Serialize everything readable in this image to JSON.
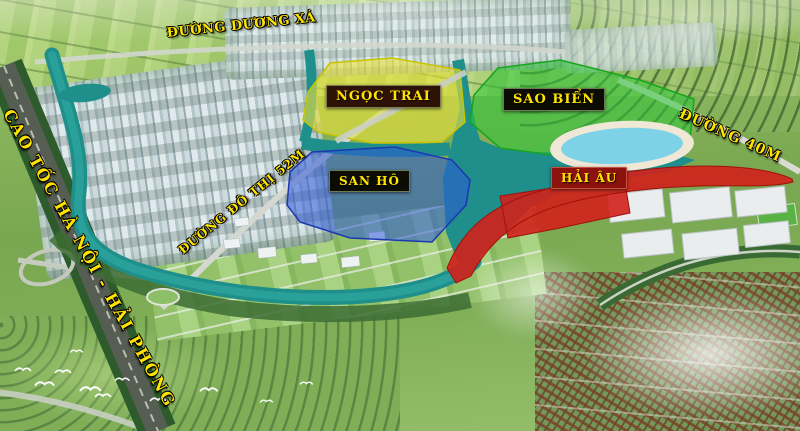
{
  "map": {
    "road_labels": {
      "duong_duong_xa": "ĐƯỜNG DƯƠNG XÁ",
      "cao_toc": "CAO TỐC HÀ NỘI - HẢI PHÒNG",
      "duong_do_thi_52m": "ĐƯỜNG ĐÔ THỊ 52M",
      "duong_40m": "ĐƯỜNG 40M"
    },
    "zones": {
      "ngoc_trai": {
        "label": "NGỌC TRAI",
        "color": "#ece33a"
      },
      "sao_bien": {
        "label": "SAO BIỂN",
        "color": "#2ec73b"
      },
      "san_ho": {
        "label": "SAN HÔ",
        "color": "#2d57d8"
      },
      "hai_au": {
        "label": "HẢI ÂU",
        "color": "#d2201a"
      }
    },
    "colors": {
      "label_text": "#ffe400",
      "lake_water": "#1e8f8b",
      "lagoon_water": "#7ed2e8",
      "beach_sand": "#efe8d6"
    }
  }
}
